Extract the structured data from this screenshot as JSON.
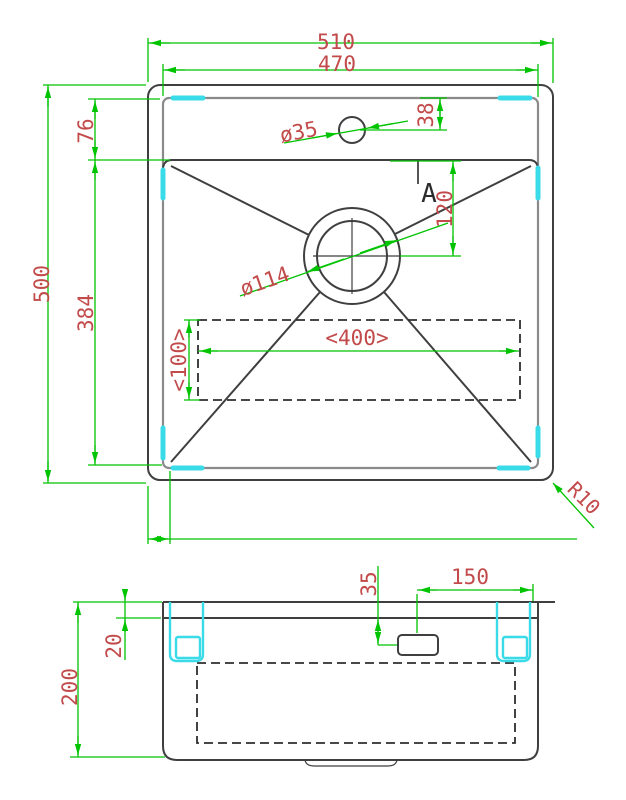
{
  "drawing": {
    "type": "sink-technical-drawing",
    "views": [
      "top-plan-view",
      "front-section-view"
    ]
  },
  "colors": {
    "dimension_line_green": "#00c400",
    "dimension_text_red": "#c24a4a",
    "outline_dark": "#3f3f3f",
    "rim_gray": "#8a8a8a",
    "clip_cyan": "#3adbe8",
    "background": "#ffffff"
  },
  "top_view": {
    "overall_width": "510",
    "inner_width": "470",
    "overall_depth": "500",
    "deck_depth": "76",
    "bowl_depth": "384",
    "faucet_offset": "38",
    "faucet_diameter": "ø35",
    "drain_diameter": "ø114",
    "drain_offset": "120",
    "pad_width": "<400>",
    "pad_height": "<100>",
    "corner_radius": "R10",
    "section_label": "A"
  },
  "side_view": {
    "overall_height": "200",
    "rim_height": "20",
    "drain_offset_vertical": "35",
    "drain_offset_horizontal": "150"
  }
}
